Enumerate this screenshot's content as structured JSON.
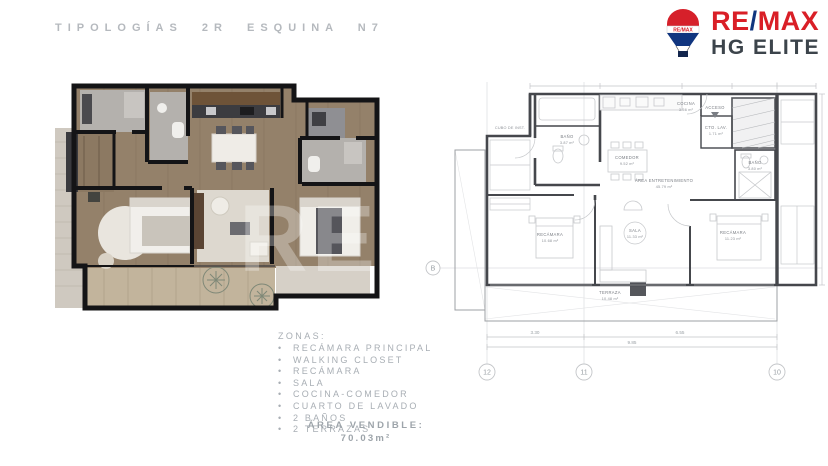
{
  "header": {
    "title": "TIPOLOGÍAS 2R ESQUINA N7"
  },
  "logo": {
    "brand_re": "RE",
    "brand_slash": "/",
    "brand_max": "MAX",
    "subtitle": "HG ELITE",
    "balloon_label": "RE/MAX",
    "red": "#d91f27",
    "blue": "#10357f"
  },
  "watermark": "RE",
  "zones": {
    "heading": "ZONAS:",
    "bullet": "•",
    "items": [
      "RECÁMARA PRINCIPAL",
      "WALKING CLOSET",
      "RECÁMARA",
      "SALA",
      "COCINA-COMEDOR",
      "CUARTO DE LAVADO",
      "2 BAÑOS",
      "2 TERRAZAS"
    ]
  },
  "area": {
    "label": "ÁREA VENDIBLE:",
    "value": "70.03m²"
  },
  "technical_plan": {
    "rooms": {
      "cocina": {
        "name": "COCINA",
        "area": "3.56 m²"
      },
      "acceso": {
        "name": "ACCESO",
        "area": ""
      },
      "cto_lav": {
        "name": "CTO. LAV.",
        "area": "1.71 m²"
      },
      "bano_1": {
        "name": "BAÑO",
        "area": "3.87 m²"
      },
      "bano_2": {
        "name": "BAÑO",
        "area": "3.80 m²"
      },
      "comedor": {
        "name": "COMEDOR",
        "area": "9.52 m²"
      },
      "area_ent": {
        "name": "ÁREA ENTRETENIMIENTO",
        "area": "45.79 m²"
      },
      "sala": {
        "name": "SALA",
        "area": "11.33 m²"
      },
      "recamara_1": {
        "name": "RECÁMARA",
        "area": "10.68 m²"
      },
      "recamara_2": {
        "name": "RECÁMARA",
        "area": "11.23 m²"
      },
      "terraza": {
        "name": "TERRAZA",
        "area": "10.48 m²"
      },
      "cubo": {
        "name": "CUBO DE INST."
      }
    },
    "grid": {
      "row": "B",
      "cols": [
        "12",
        "11",
        "10"
      ]
    },
    "dimensions": {
      "seg_left": "3.30",
      "seg_right": "6.55",
      "total": "9.85"
    }
  }
}
